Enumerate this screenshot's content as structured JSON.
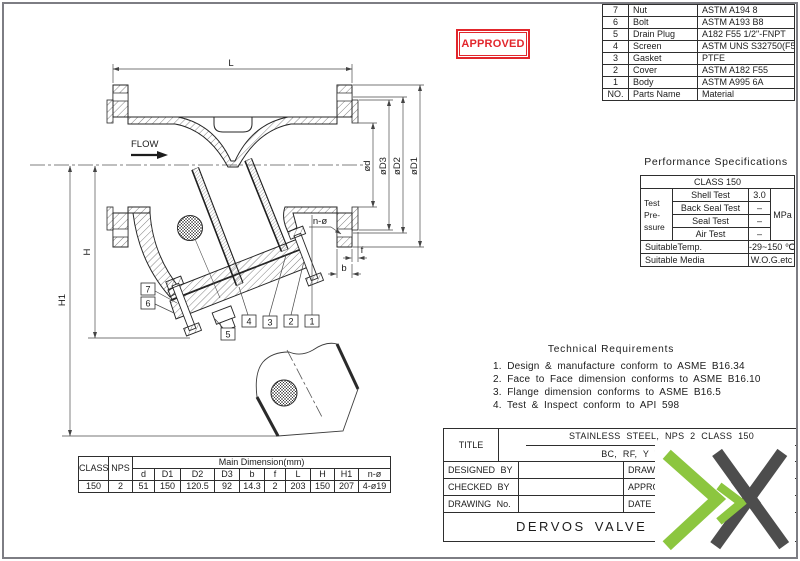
{
  "stamp": {
    "text": "APPROVED",
    "color": "#e2262c"
  },
  "logo": {
    "green": "#8cc63f",
    "dark": "#4d4d4d"
  },
  "parts_table": {
    "rows": [
      {
        "no": "7",
        "name": "Nut",
        "material": "ASTM A194 8"
      },
      {
        "no": "6",
        "name": "Bolt",
        "material": "ASTM A193 B8"
      },
      {
        "no": "5",
        "name": "Drain Plug",
        "material": "A182 F55 1/2\"-FNPT"
      },
      {
        "no": "4",
        "name": "Screen",
        "material": "ASTM UNS S32750(F53)"
      },
      {
        "no": "3",
        "name": "Gasket",
        "material": "PTFE"
      },
      {
        "no": "2",
        "name": "Cover",
        "material": "ASTM A182 F55"
      },
      {
        "no": "1",
        "name": "Body",
        "material": "ASTM A995 6A"
      },
      {
        "no": "NO.",
        "name": "Parts Name",
        "material": "Material"
      }
    ]
  },
  "performance": {
    "title": "Performance Specifications",
    "class_header": "CLASS 150",
    "pressure_label": [
      "Test",
      "Pre-",
      "ssure"
    ],
    "tests": [
      {
        "name": "Shell Test",
        "value": "3.0"
      },
      {
        "name": "Back Seal Test",
        "value": "–"
      },
      {
        "name": "Seal Test",
        "value": "–"
      },
      {
        "name": "Air Test",
        "value": "–"
      }
    ],
    "unit": "MPa",
    "temp_label": "SuitableTemp.",
    "temp_value": "-29~150 ℃",
    "media_label": "Suitable Media",
    "media_value": "W.O.G.etc"
  },
  "technical": {
    "title": "Technical Requirements",
    "items": [
      "1. Design & manufacture conform to ASME B16.34",
      "2. Face to Face dimension conforms to ASME B16.10",
      "3. Flange dimension conforms to ASME B16.5",
      "4. Test & Inspect conform to API 598"
    ]
  },
  "dimension_table": {
    "class_label": "CLASS",
    "nps_label": "NPS",
    "group_label": "Main Dimension(mm)",
    "columns": [
      "d",
      "D1",
      "D2",
      "D3",
      "b",
      "f",
      "L",
      "H",
      "H1",
      "n-ø"
    ],
    "class_value": "150",
    "nps_value": "2",
    "values": [
      "51",
      "150",
      "120.5",
      "92",
      "14.3",
      "2",
      "203",
      "150",
      "207",
      "4-ø19"
    ]
  },
  "title_block": {
    "title_label": "TITLE",
    "title_line1": "STAINLESS STEEL, NPS 2 CLASS 150",
    "title_line2": "BC, RF, Y TYPE-ST",
    "designed_by": "DESIGNED BY",
    "checked_by": "CHECKED BY",
    "drawing_no": "DRAWING No.",
    "drawn": "DRAWN",
    "approved": "APPROV",
    "date": "DATE",
    "company": "DERVOS VALVE CO"
  },
  "drawing": {
    "flow": "FLOW",
    "dims": {
      "L": "L",
      "H": "H",
      "H1": "H1",
      "d": "ød",
      "D3": "øD3",
      "D2": "øD2",
      "D1": "øD1",
      "n": "n-ø",
      "f": "f",
      "b": "b"
    },
    "part_numbers": [
      "1",
      "2",
      "3",
      "4",
      "5",
      "6",
      "7"
    ]
  }
}
